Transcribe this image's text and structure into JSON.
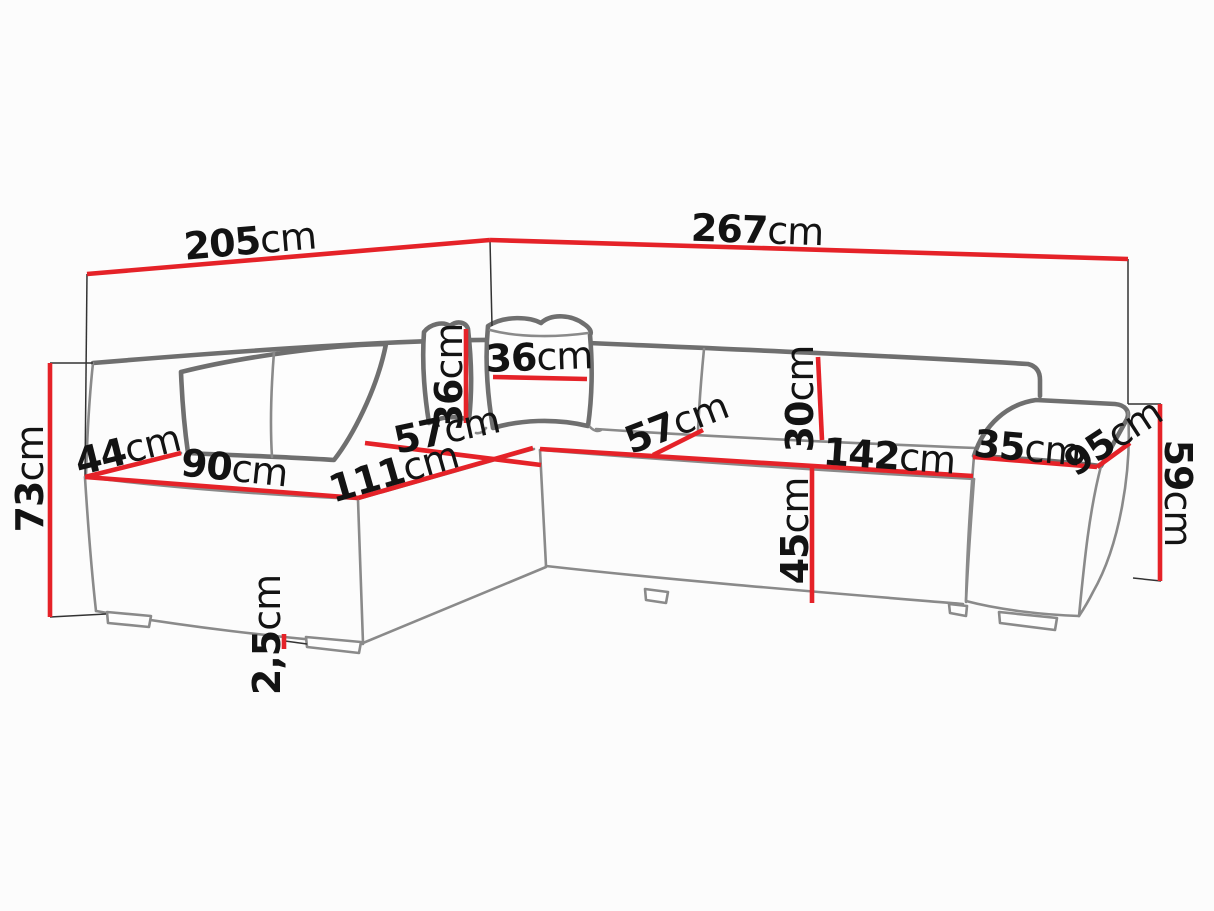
{
  "diagram": {
    "subject": "corner-sofa-dimension-diagram",
    "unit": "cm"
  },
  "colors": {
    "dimension_line": "#e52228",
    "outline": "#8a8a8a",
    "outline_dark": "#6f6f6f",
    "extension_line": "#333333",
    "text": "#131313",
    "background": "#fcfcfc"
  },
  "dims": {
    "width_left": {
      "value": "205",
      "unit": "cm"
    },
    "width_right": {
      "value": "267",
      "unit": "cm"
    },
    "height_total": {
      "value": "73",
      "unit": "cm"
    },
    "end_width": {
      "value": "44",
      "unit": "cm"
    },
    "front_left": {
      "value": "90",
      "unit": "cm"
    },
    "front_corner": {
      "value": "111",
      "unit": "cm"
    },
    "seat_depth_left": {
      "value": "57",
      "unit": "cm"
    },
    "pillow_height": {
      "value": "36",
      "unit": "cm"
    },
    "pillow_width": {
      "value": "36",
      "unit": "cm"
    },
    "seat_depth_right": {
      "value": "57",
      "unit": "cm"
    },
    "backrest_height": {
      "value": "30",
      "unit": "cm"
    },
    "front_right": {
      "value": "142",
      "unit": "cm"
    },
    "seat_height": {
      "value": "45",
      "unit": "cm"
    },
    "armrest_width": {
      "value": "35",
      "unit": "cm"
    },
    "armrest_depth": {
      "value": "95",
      "unit": "cm"
    },
    "armrest_height": {
      "value": "59",
      "unit": "cm"
    },
    "leg_height": {
      "value": "2,5",
      "unit": "cm"
    }
  }
}
